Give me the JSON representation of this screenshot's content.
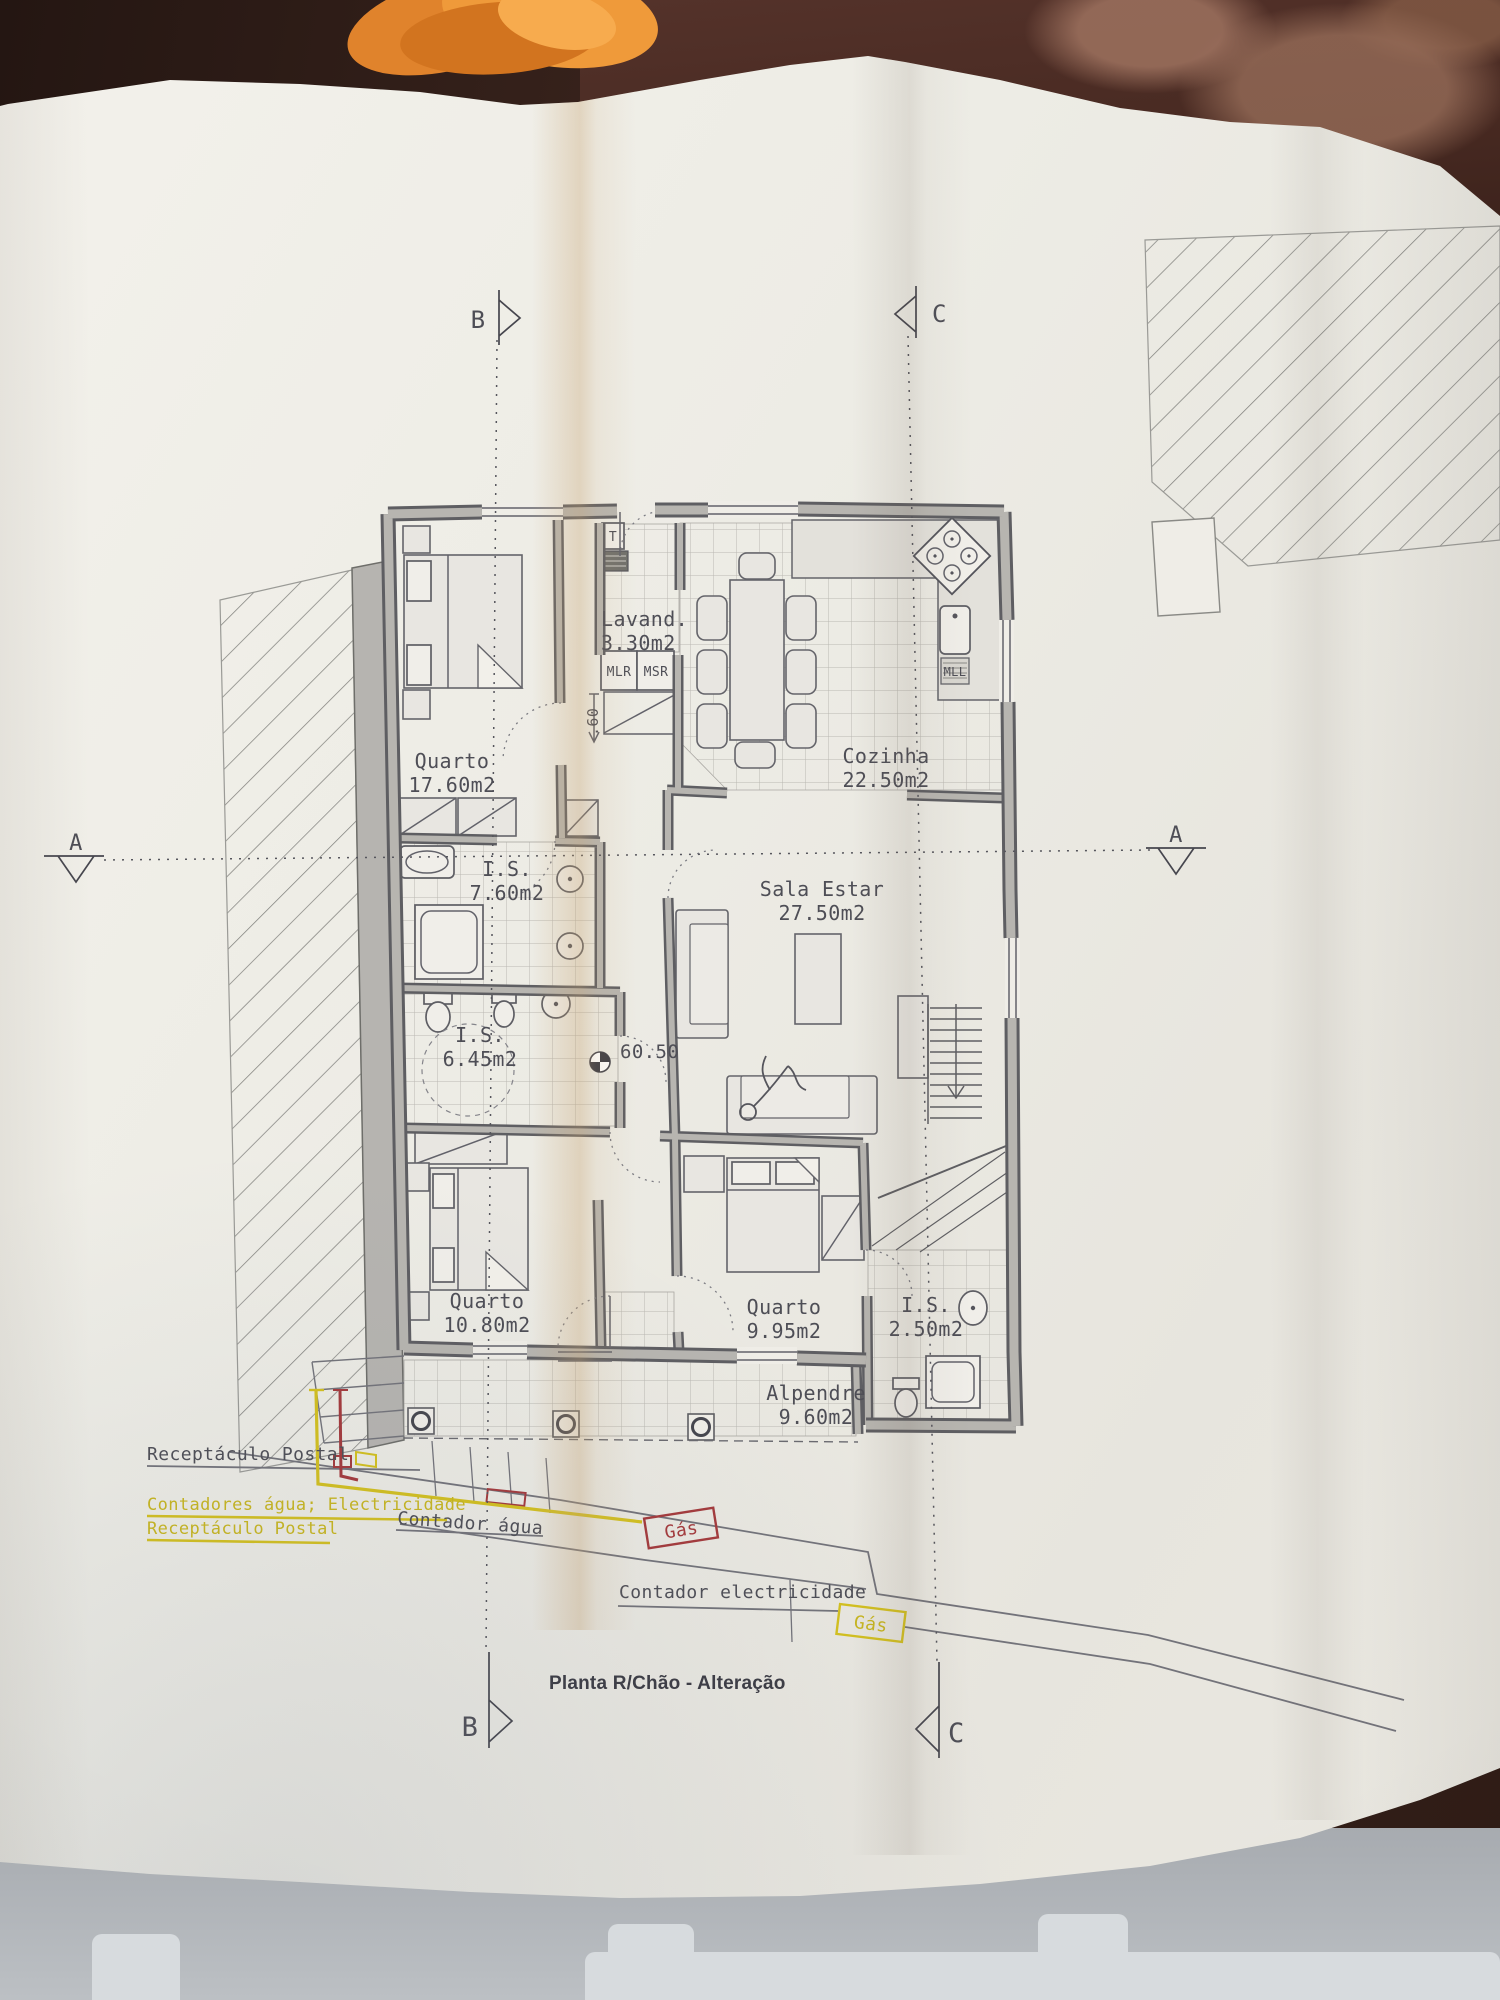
{
  "plan": {
    "title": "Planta R/Chão - Alteração",
    "rooms": {
      "quarto1": {
        "name": "Quarto",
        "area": "17.60m2"
      },
      "lavandaria": {
        "name": "Lavand.",
        "area": "3.30m2"
      },
      "cozinha": {
        "name": "Cozinha",
        "area": "22.50m2"
      },
      "is1": {
        "name": "I.S.",
        "area": "7.60m2"
      },
      "sala": {
        "name": "Sala Estar",
        "area": "27.50m2"
      },
      "is2": {
        "name": "I.S.",
        "area": "6.45m2"
      },
      "quarto2": {
        "name": "Quarto",
        "area": "10.80m2"
      },
      "quarto3": {
        "name": "Quarto",
        "area": "9.95m2"
      },
      "is3": {
        "name": "I.S.",
        "area": "2.50m2"
      },
      "alpendre": {
        "name": "Alpendre",
        "area": "9.60m2"
      }
    },
    "appliance_tags": {
      "t": "T",
      "mlr": "MLR",
      "msr": "MSR",
      "mll": "MLL"
    },
    "levels": {
      "floor_level": "60.50",
      "step_height": ".60"
    },
    "section_markers": {
      "a": "A",
      "b": "B",
      "c": "C"
    },
    "annotations": {
      "receptaculo_postal": "Receptáculo Postal",
      "contadores": "Contadores água; Electricidade",
      "receptaculo_postal_yellow": "Receptáculo Postal",
      "contador_agua": "Contador água",
      "gas_red": "Gás",
      "contador_electricidade": "Contador electricidade",
      "gas_yellow": "Gás"
    },
    "colors": {
      "ink": "#4e4e56",
      "wall_fill": "#b7b5b0",
      "utility_red": "#a43a3c",
      "utility_yellow": "#d3c01f"
    }
  }
}
